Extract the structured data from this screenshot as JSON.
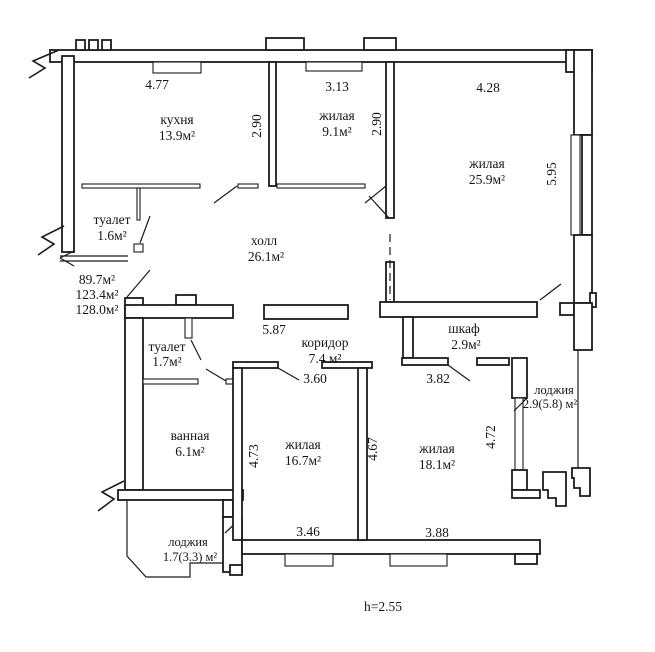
{
  "plan": {
    "type": "apartment-floor-plan",
    "height_note": "h=2.55",
    "colors": {
      "ink": "#1c1c1c",
      "paper": "#ffffff"
    },
    "area_summary": [
      "89.7м²",
      "123.4м²",
      "128.0м²"
    ],
    "rooms": {
      "kitchen": {
        "name": "кухня",
        "area": "13.9м²"
      },
      "living_small": {
        "name": "жилая",
        "area": "9.1м²"
      },
      "living_large": {
        "name": "жилая",
        "area": "25.9м²"
      },
      "toilet_upper": {
        "name": "туалет",
        "area": "1.6м²"
      },
      "hall": {
        "name": "холл",
        "area": "26.1м²"
      },
      "toilet_lower": {
        "name": "туалет",
        "area": "1.7м²"
      },
      "corridor": {
        "name": "коридор",
        "area": "7.4 м²"
      },
      "closet": {
        "name": "шкаф",
        "area": "2.9м²"
      },
      "bathroom": {
        "name": "ванная",
        "area": "6.1м²"
      },
      "living_mid": {
        "name": "жилая",
        "area": "16.7м²"
      },
      "living_right": {
        "name": "жилая",
        "area": "18.1м²"
      },
      "loggia_right": {
        "name": "лоджия",
        "area": "2.9(5.8) м²"
      },
      "loggia_left": {
        "name": "лоджия",
        "area": "1.7(3.3) м²"
      }
    },
    "dims": {
      "top_kitchen": "4.77",
      "top_living_small": "3.13",
      "top_living_large": "4.28",
      "kitchen_side": "2.90",
      "living_small_side": "2.90",
      "living_large_side": "5.95",
      "mid_wall": "5.87",
      "corridor_left": "3.60",
      "corridor_right": "3.82",
      "living_mid_left": "4.73",
      "living_right_left": "4.67",
      "living_right_side": "4.72",
      "bottom_living_mid": "3.46",
      "bottom_living_right": "3.88"
    }
  }
}
